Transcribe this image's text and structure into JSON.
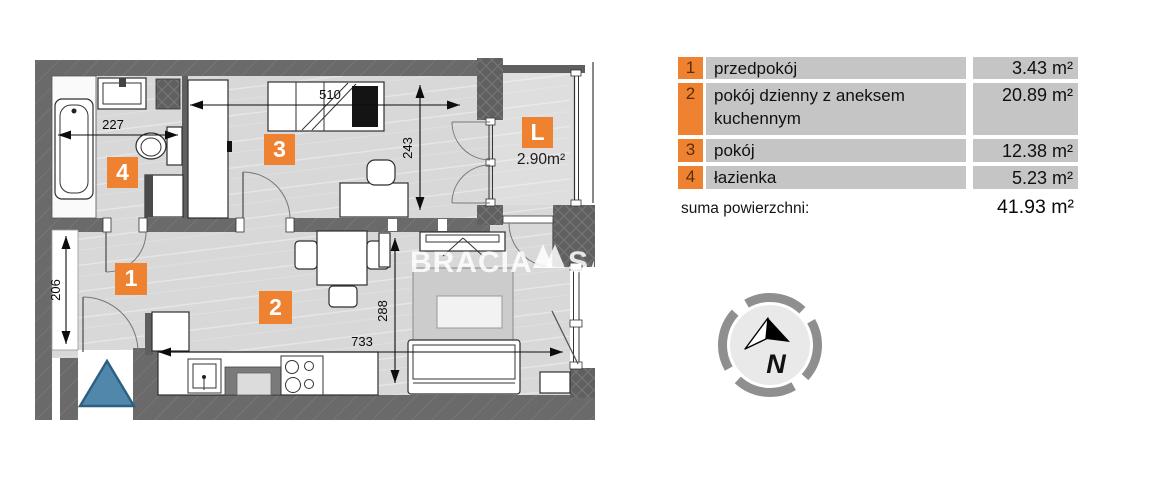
{
  "colors": {
    "accent": "#ef8230",
    "wall": "#6a6a6a",
    "floor": "#d8d8d8",
    "loggia-floor": "#dedede",
    "row-bg": "#c5c5c5",
    "badge-num": "#5c2d08",
    "blue": "#5287ac"
  },
  "plan": {
    "badges": {
      "hall": "1",
      "living": "2",
      "room": "3",
      "bath": "4",
      "loggia": "L"
    },
    "loggia_area": "2.90m²",
    "dims": {
      "bath_width": "227",
      "room_width": "510",
      "room_depth": "243",
      "hall_height": "206",
      "living_depth": "288",
      "living_width": "733"
    },
    "watermark": {
      "left": "BRACIA",
      "right": "SA"
    }
  },
  "legend": {
    "rows": [
      {
        "num": "1",
        "name": "przedpokój",
        "area": "3.43 m²"
      },
      {
        "num": "2",
        "name": "pokój dzienny z aneksem kuchennym",
        "area": "20.89 m²"
      },
      {
        "num": "3",
        "name": "pokój",
        "area": "12.38 m²"
      },
      {
        "num": "4",
        "name": "łazienka",
        "area": "5.23 m²"
      }
    ],
    "total_label": "suma powierzchni:",
    "total_value": "41.93 m²"
  },
  "compass": {
    "label": "N"
  }
}
